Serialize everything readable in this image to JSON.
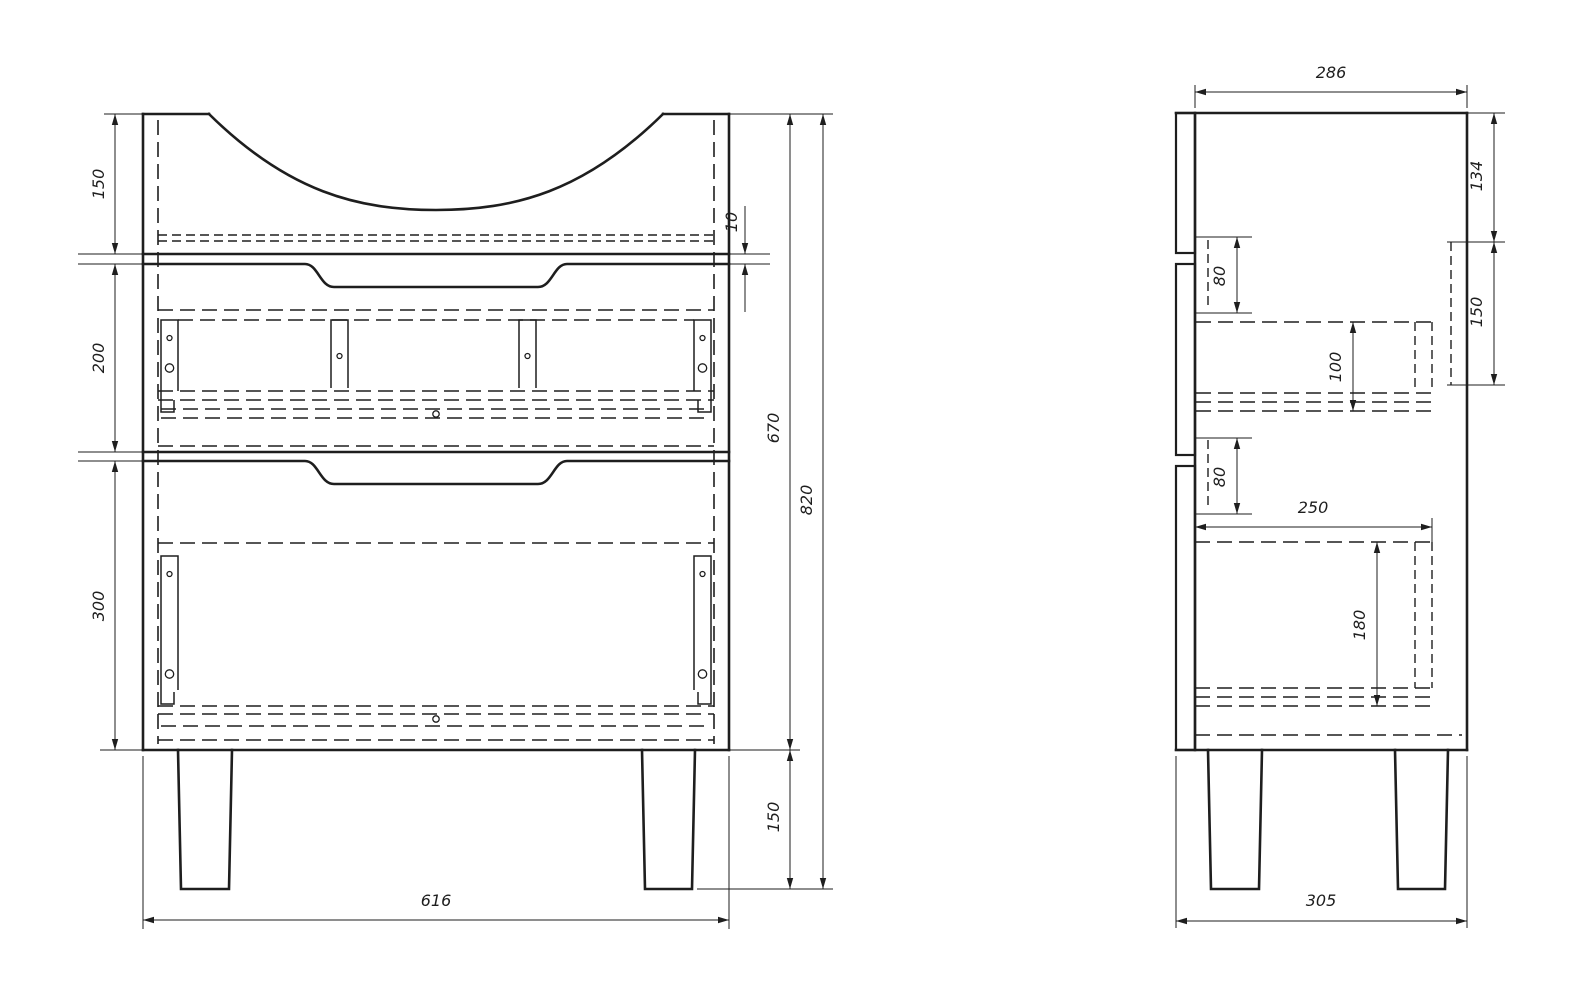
{
  "drawing": {
    "title": "cabinet-technical-drawing",
    "background_color": "#ffffff",
    "line_color": "#1e1e1e",
    "front_view": {
      "top_section_height": "150",
      "middle_section_height": "200",
      "bottom_section_height": "300",
      "top_gap": "10",
      "carcass_height": "670",
      "overall_height": "820",
      "leg_height": "150",
      "overall_width": "616"
    },
    "side_view": {
      "depth": "286",
      "top_to_back_rail": "134",
      "upper_slide_height": "80",
      "upper_drawer_box_height": "100",
      "back_rail_height": "150",
      "lower_slide_height": "80",
      "lower_drawer_box_depth": "250",
      "lower_drawer_box_height": "180",
      "base_depth": "305"
    }
  }
}
